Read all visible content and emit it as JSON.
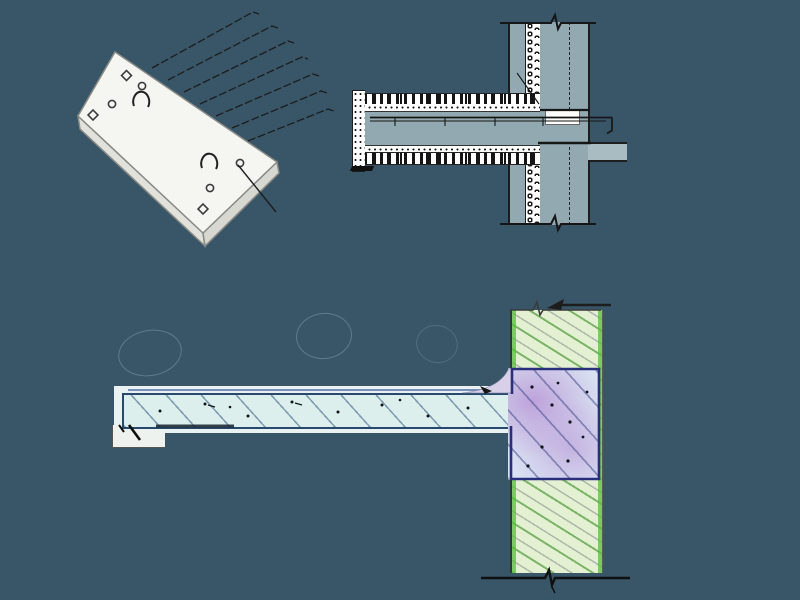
{
  "colors": {
    "background": "#385668",
    "plate-fill": "#f5f5f2",
    "plate-side": "#e2e2dd",
    "plate-stroke": "#8a8a86",
    "line-dark": "#1d1d1d",
    "wall-gray": "#92a9b1",
    "floor-bar": "#a9bcc2",
    "insulation-white": "#ffffff",
    "slab-cyan": "#dcefec",
    "slab-outline": "#27496e",
    "accent-blue": "#5a77b0",
    "wall-green": "#e4f0d2",
    "wall-green-edge": "#5ab83e",
    "zone-blue": "#d9e2f2",
    "zone-purple": "#c9a8d8",
    "zone-outline": "#2a2f7d",
    "haunch": "#d8cfe9",
    "white-band": "#e9f1f1",
    "ellipse-stroke": "rgba(195,210,220,0.3)"
  },
  "figures": {
    "isometric-plate": {
      "rebar-count": 7,
      "lifting-hooks": 2,
      "holes": 7
    },
    "wall-section-detail": {
      "wall-layers": 3,
      "insulation-pattern": "circles",
      "rebar-lines": 2
    },
    "balcony-connection": {
      "regions": [
        "balcony-slab",
        "wall",
        "connection-zone"
      ]
    }
  }
}
